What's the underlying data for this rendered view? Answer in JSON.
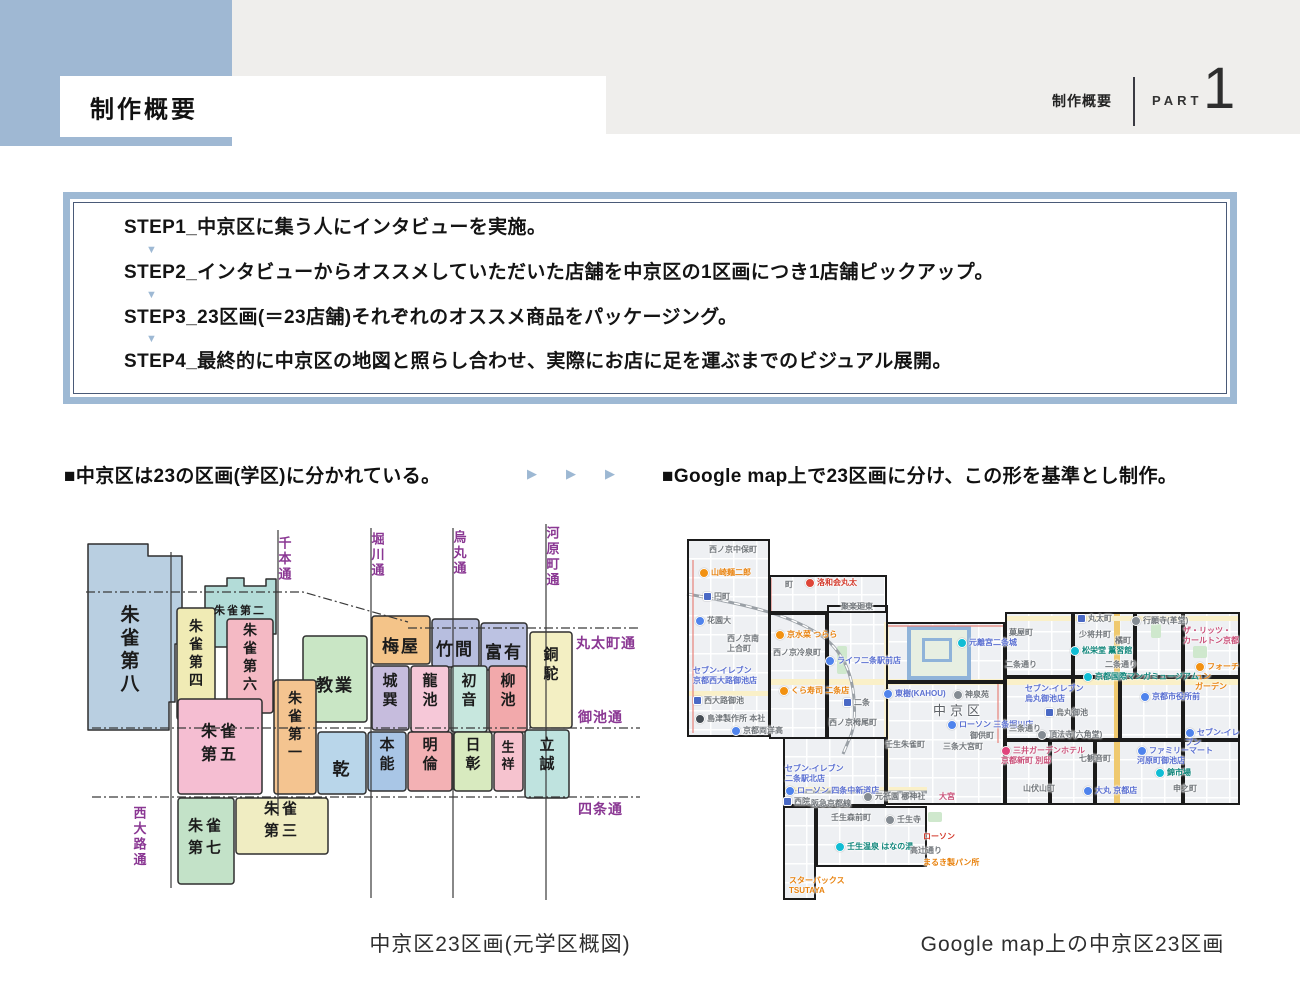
{
  "page": {
    "width": 1300,
    "height": 1000,
    "accent": "#9eb9d4",
    "band_gray": "#efeeec",
    "accent_blue_rect": "#9fb8d3"
  },
  "icons": {
    "down_triangle": "▼",
    "right_triangle": "▶"
  },
  "header": {
    "title": "制作概要",
    "right_title": "制作概要",
    "part_label": "PART",
    "part_number": "1"
  },
  "steps": {
    "items": [
      "STEP1_中京区に集う人にインタビューを実施。",
      "STEP2_インタビューからオススメしていただいた店舗を中京区の1区画につき1店舗ピックアップ。",
      "STEP3_23区画(＝23店舗)それぞれのオススメ商品をパッケージング。",
      "STEP4_最終的に中京区の地図と照らし合わせ、実際にお店に足を運ぶまでのビジュアル展開。"
    ]
  },
  "sections": {
    "left_heading": "■中京区は23の区画(学区)に分かれている。",
    "right_heading": "■Google map上で23区画に分け、この形を基準とし制作。",
    "arrow_count": 3
  },
  "left_map": {
    "caption": "中京区23区画(元学区概図)",
    "street_color": "#8a3793",
    "line_color": "#3a3a3a",
    "streets_vertical": [
      {
        "x": 93,
        "y1": 36,
        "y2": 372,
        "label": "西大路通",
        "lx": 62,
        "ly": 292
      },
      {
        "x": 200,
        "y1": 14,
        "y2": 300,
        "label": "千本通",
        "lx": 207,
        "ly": 22
      },
      {
        "x": 293,
        "y1": 12,
        "y2": 382,
        "label": "堀川通",
        "lx": 300,
        "ly": 18
      },
      {
        "x": 375,
        "y1": 12,
        "y2": 382,
        "label": "烏丸通",
        "lx": 382,
        "ly": 16
      },
      {
        "x": 468,
        "y1": 8,
        "y2": 384,
        "label": "河原町通",
        "lx": 475,
        "ly": 12
      }
    ],
    "streets_horizontal": [
      {
        "pts": "8,76 225,76 330,106",
        "label": "",
        "lx": 0,
        "ly": 0
      },
      {
        "pts": "330,112 562,112",
        "label": "丸太町通",
        "lx": 498,
        "ly": 132
      },
      {
        "pts": "14,212 562,212",
        "label": "御池通",
        "lx": 500,
        "ly": 206
      },
      {
        "pts": "14,281 562,281",
        "label": "四条通",
        "lx": 500,
        "ly": 298
      }
    ],
    "districts": [
      {
        "name": "朱雀第八",
        "poly": "10,28 70,28 70,40 104,40 104,128 97,128 97,186 91,186 91,214 10,214",
        "color": "#b9cfe1",
        "label": {
          "x": 52,
          "y": 92,
          "mode": "v",
          "size": 19
        }
      },
      {
        "name": "朱雀第二",
        "poly": "127,70 149,70 149,62 166,62 166,70 188,70 188,63 198,63 198,118 161,118 161,131 127,131",
        "color": "#b3dcd8",
        "label": {
          "x": 162,
          "y": 91,
          "mode": "h",
          "size": 11
        }
      },
      {
        "name": "朱雀第四",
        "rect": [
          99,
          92,
          38,
          112
        ],
        "color": "#f0ebb5",
        "label": {
          "x": 118,
          "y": 106,
          "mode": "v",
          "size": 14
        }
      },
      {
        "name": "朱雀第六",
        "rect": [
          149,
          103,
          46,
          94
        ],
        "color": "#f4b9c4",
        "label": {
          "x": 172,
          "y": 110,
          "mode": "v",
          "size": 14
        }
      },
      {
        "name": "教業",
        "rect": [
          225,
          120,
          64,
          86
        ],
        "color": "#c9e6c5",
        "label": {
          "x": 257,
          "y": 163,
          "mode": "h",
          "size": 17
        }
      },
      {
        "name": "梅屋",
        "rect": [
          294,
          100,
          58,
          48
        ],
        "color": "#f4c489",
        "label": {
          "x": 323,
          "y": 124,
          "mode": "h",
          "size": 17
        }
      },
      {
        "name": "竹間",
        "rect": [
          354,
          103,
          47,
          48
        ],
        "color": "#b7bedf",
        "label": {
          "x": 377,
          "y": 127,
          "mode": "h",
          "size": 17
        }
      },
      {
        "name": "富有",
        "rect": [
          403,
          107,
          46,
          47
        ],
        "color": "#bcc2e2",
        "label": {
          "x": 426,
          "y": 130,
          "mode": "h",
          "size": 17
        }
      },
      {
        "name": "銅駝",
        "rect": [
          452,
          116,
          42,
          96
        ],
        "color": "#f3efc3",
        "label": {
          "x": 473,
          "y": 134,
          "mode": "v",
          "size": 15
        }
      },
      {
        "name": "城巽",
        "rect": [
          294,
          150,
          37,
          64
        ],
        "color": "#c6bcdd",
        "label": {
          "x": 312,
          "y": 160,
          "mode": "v",
          "size": 15
        }
      },
      {
        "name": "龍池",
        "rect": [
          333,
          150,
          38,
          66
        ],
        "color": "#f6c8d8",
        "label": {
          "x": 352,
          "y": 160,
          "mode": "v",
          "size": 15
        }
      },
      {
        "name": "初音",
        "rect": [
          373,
          150,
          36,
          66
        ],
        "color": "#c7e7de",
        "label": {
          "x": 391,
          "y": 160,
          "mode": "v",
          "size": 15
        }
      },
      {
        "name": "柳池",
        "rect": [
          411,
          150,
          38,
          66
        ],
        "color": "#f2a9ab",
        "label": {
          "x": 430,
          "y": 160,
          "mode": "v",
          "size": 15
        }
      },
      {
        "name": "本能",
        "rect": [
          290,
          216,
          38,
          59
        ],
        "color": "#a9c6e6",
        "label": {
          "x": 309,
          "y": 224,
          "mode": "v",
          "size": 15
        }
      },
      {
        "name": "明倫",
        "rect": [
          330,
          216,
          44,
          59
        ],
        "color": "#f3b1b4",
        "label": {
          "x": 352,
          "y": 224,
          "mode": "v",
          "size": 15
        }
      },
      {
        "name": "日彰",
        "rect": [
          376,
          216,
          38,
          59
        ],
        "color": "#d8eabf",
        "label": {
          "x": 395,
          "y": 224,
          "mode": "v",
          "size": 15
        }
      },
      {
        "name": "生祥",
        "rect": [
          416,
          216,
          29,
          59
        ],
        "color": "#f6c3cf",
        "label": {
          "x": 430,
          "y": 226,
          "mode": "v",
          "size": 13
        }
      },
      {
        "name": "立誠",
        "rect": [
          447,
          214,
          44,
          68
        ],
        "color": "#bfe3df",
        "label": {
          "x": 469,
          "y": 224,
          "mode": "v",
          "size": 15
        }
      },
      {
        "name": "乾",
        "rect": [
          240,
          216,
          48,
          62
        ],
        "color": "#b9d6ea",
        "label": {
          "x": 264,
          "y": 247,
          "mode": "h",
          "size": 17
        }
      },
      {
        "name": "朱雀第一",
        "rect": [
          196,
          164,
          42,
          114
        ],
        "color": "#f4c490",
        "label": {
          "x": 217,
          "y": 178,
          "mode": "v",
          "size": 14
        }
      },
      {
        "name": "朱雀第五",
        "rect": [
          100,
          183,
          84,
          95
        ],
        "color": "#f5bed2",
        "label": {
          "x": 142,
          "y": 210,
          "mode": "2",
          "size": 16
        }
      },
      {
        "name": "朱雀第七",
        "rect": [
          100,
          282,
          56,
          86
        ],
        "color": "#c3e2c8",
        "label": {
          "x": 128,
          "y": 305,
          "mode": "2",
          "size": 15
        }
      },
      {
        "name": "朱雀第三",
        "rect": [
          158,
          282,
          92,
          56
        ],
        "color": "#f0edc2",
        "label": {
          "x": 204,
          "y": 288,
          "mode": "2",
          "size": 15
        }
      }
    ]
  },
  "right_map": {
    "caption": "Google map上の中京区23区画",
    "tiles": [
      [
        2,
        11,
        83,
        198
      ],
      [
        84,
        47,
        118,
        38
      ],
      [
        84,
        85,
        58,
        126
      ],
      [
        142,
        77,
        61,
        134
      ],
      [
        201,
        94,
        119,
        60
      ],
      [
        201,
        154,
        119,
        123
      ],
      [
        98,
        209,
        103,
        69
      ],
      [
        98,
        278,
        33,
        94
      ],
      [
        131,
        278,
        111,
        61
      ],
      [
        320,
        84,
        68,
        65
      ],
      [
        388,
        84,
        62,
        65
      ],
      [
        450,
        84,
        48,
        65
      ],
      [
        498,
        84,
        57,
        65
      ],
      [
        320,
        149,
        68,
        63
      ],
      [
        388,
        149,
        47,
        63
      ],
      [
        435,
        149,
        63,
        63
      ],
      [
        498,
        149,
        57,
        63
      ],
      [
        320,
        212,
        45,
        65
      ],
      [
        365,
        212,
        45,
        65
      ],
      [
        410,
        212,
        88,
        65
      ],
      [
        498,
        212,
        57,
        65
      ]
    ],
    "roads": [
      {
        "x": 84,
        "y": 151,
        "w": 471,
        "h": 6,
        "c": "#faf0c8"
      },
      {
        "x": 2,
        "y": 163,
        "w": 83,
        "h": 5,
        "c": "#faf0c8"
      },
      {
        "x": 429,
        "y": 84,
        "w": 6,
        "h": 193,
        "c": "#efc96f"
      },
      {
        "x": 320,
        "y": 88,
        "w": 235,
        "h": 5,
        "c": "#faf0c8"
      },
      {
        "x": 98,
        "y": 259,
        "w": 144,
        "h": 4,
        "c": "#faf0c8"
      },
      {
        "x": 199,
        "y": 94,
        "w": 5,
        "h": 183,
        "c": "#fbf3d4"
      }
    ],
    "parks": [
      {
        "x": 152,
        "y": 118,
        "w": 10,
        "h": 28
      },
      {
        "x": 243,
        "y": 284,
        "w": 14,
        "h": 10
      },
      {
        "x": 466,
        "y": 96,
        "w": 10,
        "h": 14
      },
      {
        "x": 508,
        "y": 118,
        "w": 14,
        "h": 12
      }
    ],
    "castle": {
      "x": 222,
      "y": 98,
      "w": 56,
      "h": 46
    },
    "rail_paths": [
      "M 2,66 C 60,76 112,88 142,112 C 160,128 167,148 169,170 C 171,196 167,206 163,214 L 158,226",
      "M 98,264 L 242,264"
    ],
    "boundary_paths": [
      "M 8,32 L 8,205",
      "M 86,50 L 86,84",
      "M 201,98 L 318,98",
      "M 313,156 L 313,215"
    ],
    "labels": [
      {
        "x": 24,
        "y": 17,
        "t": "西ノ京中保町",
        "c": "gray"
      },
      {
        "x": 14,
        "y": 40,
        "t": "山崎麺二郎",
        "c": "orange",
        "pin": "orange"
      },
      {
        "x": 18,
        "y": 64,
        "t": "円町",
        "c": "gray",
        "pin": "station"
      },
      {
        "x": 10,
        "y": 88,
        "t": "花園大",
        "c": "gray",
        "pin": "blue"
      },
      {
        "x": 42,
        "y": 106,
        "t": "西ノ京南\n上合町",
        "c": "gray"
      },
      {
        "x": 8,
        "y": 138,
        "t": "セブン-イレブン\n京都西大路御池店",
        "c": "blue"
      },
      {
        "x": 8,
        "y": 168,
        "t": "西大路御池",
        "c": "gray",
        "pin": "station"
      },
      {
        "x": 10,
        "y": 186,
        "t": "島津製作所 本社",
        "c": "gray",
        "pin": "dark"
      },
      {
        "x": 46,
        "y": 198,
        "t": "京都両洋高",
        "c": "gray",
        "pin": "blue"
      },
      {
        "x": 100,
        "y": 52,
        "t": "町",
        "c": "gray"
      },
      {
        "x": 120,
        "y": 50,
        "t": "洛和会丸太",
        "c": "red",
        "pin": "red"
      },
      {
        "x": 156,
        "y": 74,
        "t": "聚楽廻東",
        "c": "gray"
      },
      {
        "x": 90,
        "y": 102,
        "t": "京水菜 つらら",
        "c": "orange",
        "pin": "orange"
      },
      {
        "x": 88,
        "y": 120,
        "t": "西ノ京冷泉町",
        "c": "gray"
      },
      {
        "x": 94,
        "y": 158,
        "t": "くら寿司 二条店",
        "c": "orange",
        "pin": "orange"
      },
      {
        "x": 140,
        "y": 128,
        "t": "ライフ二条駅前店",
        "c": "blue",
        "pin": "blue"
      },
      {
        "x": 158,
        "y": 170,
        "t": "二条",
        "c": "gray",
        "pin": "station"
      },
      {
        "x": 144,
        "y": 190,
        "t": "西ノ京栂尾町",
        "c": "gray"
      },
      {
        "x": 272,
        "y": 110,
        "t": "元離宮二条城",
        "c": "blue",
        "pin": "teal"
      },
      {
        "x": 198,
        "y": 161,
        "t": "東樹(KAHOU)",
        "c": "blue",
        "pin": "blue"
      },
      {
        "x": 268,
        "y": 162,
        "t": "神泉苑",
        "c": "gray",
        "pin": "gray"
      },
      {
        "x": 248,
        "y": 175,
        "t": "中京区",
        "c": "ward"
      },
      {
        "x": 262,
        "y": 192,
        "t": "ローソン 三条堀川店",
        "c": "blue",
        "pin": "blue"
      },
      {
        "x": 285,
        "y": 203,
        "t": "御供町",
        "c": "gray"
      },
      {
        "x": 258,
        "y": 214,
        "t": "三条大宮町",
        "c": "gray"
      },
      {
        "x": 200,
        "y": 212,
        "t": "壬生朱雀町",
        "c": "gray"
      },
      {
        "x": 254,
        "y": 264,
        "t": "大宮",
        "c": "pink"
      },
      {
        "x": 100,
        "y": 236,
        "t": "セブン-イレブン\n二条駅北店",
        "c": "blue"
      },
      {
        "x": 100,
        "y": 258,
        "t": "ローソン 四条中新道店",
        "c": "blue",
        "pin": "blue"
      },
      {
        "x": 98,
        "y": 269,
        "t": "西院",
        "c": "gray",
        "pin": "station"
      },
      {
        "x": 126,
        "y": 271,
        "t": "阪急京都線",
        "c": "gray"
      },
      {
        "x": 178,
        "y": 264,
        "t": "元祇園 梛神社",
        "c": "gray",
        "pin": "gray"
      },
      {
        "x": 104,
        "y": 348,
        "t": "スターバックス\nTSUTAYA",
        "c": "orange"
      },
      {
        "x": 146,
        "y": 285,
        "t": "壬生森前町",
        "c": "gray"
      },
      {
        "x": 200,
        "y": 287,
        "t": "壬生寺",
        "c": "gray",
        "pin": "gray"
      },
      {
        "x": 150,
        "y": 314,
        "t": "壬生温泉 はなの湯",
        "c": "teal",
        "pin": "teal"
      },
      {
        "x": 225,
        "y": 318,
        "t": "高辻通り",
        "c": "gray"
      },
      {
        "x": 238,
        "y": 304,
        "t": "ローソン",
        "c": "red"
      },
      {
        "x": 238,
        "y": 330,
        "t": "まるき製パン所",
        "c": "orange"
      },
      {
        "x": 392,
        "y": 86,
        "t": "丸太町",
        "c": "gray",
        "pin": "station"
      },
      {
        "x": 324,
        "y": 100,
        "t": "菓屋町",
        "c": "gray"
      },
      {
        "x": 385,
        "y": 118,
        "t": "松栄堂 薫習館",
        "c": "teal",
        "pin": "teal"
      },
      {
        "x": 320,
        "y": 132,
        "t": "二条通り",
        "c": "gray"
      },
      {
        "x": 394,
        "y": 102,
        "t": "少将井町",
        "c": "gray"
      },
      {
        "x": 430,
        "y": 108,
        "t": "橘町",
        "c": "gray"
      },
      {
        "x": 420,
        "y": 132,
        "t": "二条通り",
        "c": "gray"
      },
      {
        "x": 446,
        "y": 88,
        "t": "行願寺(革堂)",
        "c": "gray",
        "pin": "gray"
      },
      {
        "x": 498,
        "y": 98,
        "t": "ザ・リッツ・\nカールトン京都",
        "c": "pink"
      },
      {
        "x": 510,
        "y": 134,
        "t": "フォーチュン\nガーデン",
        "c": "orange",
        "pin": "orange"
      },
      {
        "x": 340,
        "y": 156,
        "t": "セブン-イレブン\n烏丸御池店",
        "c": "blue"
      },
      {
        "x": 360,
        "y": 180,
        "t": "烏丸御池",
        "c": "gray",
        "pin": "station"
      },
      {
        "x": 398,
        "y": 144,
        "t": "京都国際マンガミュージアム",
        "c": "teal",
        "pin": "teal"
      },
      {
        "x": 455,
        "y": 164,
        "t": "京都市役所前",
        "c": "blue",
        "pin": "blue"
      },
      {
        "x": 324,
        "y": 196,
        "t": "三条通り",
        "c": "gray"
      },
      {
        "x": 352,
        "y": 202,
        "t": "頂法寺(六角堂)",
        "c": "gray",
        "pin": "gray"
      },
      {
        "x": 500,
        "y": 200,
        "t": "セブン-イレブン",
        "c": "blue",
        "pin": "blue"
      },
      {
        "x": 316,
        "y": 218,
        "t": "三井ガーデンホテル\n京都新町 別邸",
        "c": "pink",
        "pin": "pink"
      },
      {
        "x": 394,
        "y": 226,
        "t": "七観音町",
        "c": "gray"
      },
      {
        "x": 452,
        "y": 218,
        "t": "ファミリーマート\n河原町御池店",
        "c": "blue",
        "pin": "blue"
      },
      {
        "x": 470,
        "y": 240,
        "t": "錦市場",
        "c": "teal",
        "pin": "teal"
      },
      {
        "x": 398,
        "y": 258,
        "t": "大丸 京都店",
        "c": "blue",
        "pin": "blue"
      },
      {
        "x": 488,
        "y": 256,
        "t": "申之町",
        "c": "gray"
      },
      {
        "x": 338,
        "y": 256,
        "t": "山伏山町",
        "c": "gray"
      }
    ]
  },
  "captions": {
    "left": "中京区23区画(元学区概図)",
    "right": "Google map上の中京区23区画"
  }
}
